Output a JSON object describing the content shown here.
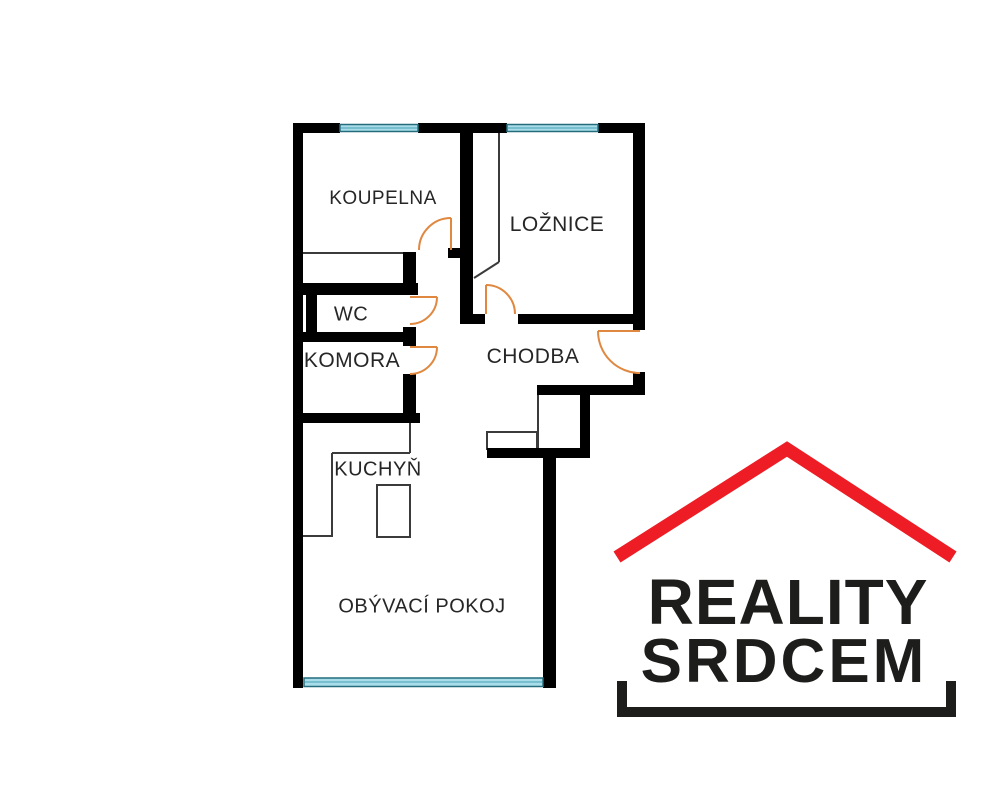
{
  "floor_plan": {
    "rooms": [
      {
        "id": "koupelna",
        "label": "KOUPELNA"
      },
      {
        "id": "loznice",
        "label": "LOŽNICE"
      },
      {
        "id": "wc",
        "label": "WC"
      },
      {
        "id": "komora",
        "label": "KOMORA"
      },
      {
        "id": "chodba",
        "label": "CHODBA"
      },
      {
        "id": "kuchyn",
        "label": "KUCHYŇ"
      },
      {
        "id": "obyvaci_pokoj",
        "label": "OBÝVACÍ POKOJ"
      }
    ],
    "colors": {
      "wall": "#000000",
      "thin_line": "#3b3b3b",
      "window_fill": "#a9dde9",
      "window_border": "#256d7c",
      "door_arc": "#e08840"
    }
  },
  "logo": {
    "line1": "REALITY",
    "line2": "SRDCEM",
    "roof_color": "#ee1c24",
    "text_color": "#1d1d1b"
  }
}
